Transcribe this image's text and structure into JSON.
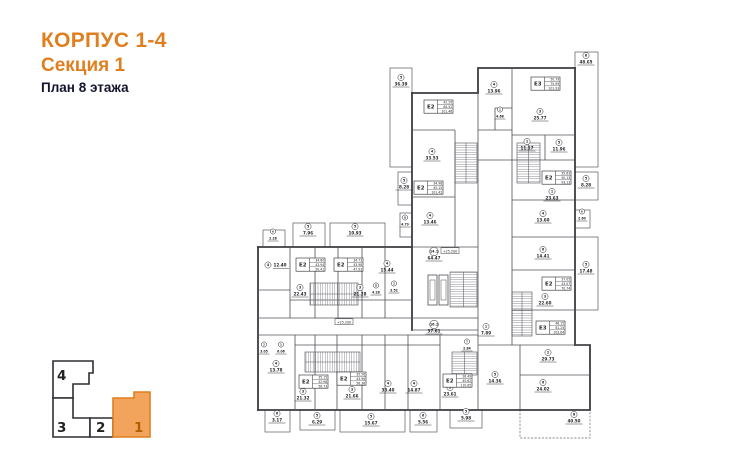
{
  "title": {
    "line1": "КОРПУС 1-4",
    "line2": "Секция 1",
    "line3": "План 8 этажа"
  },
  "colors": {
    "accent_orange": "#e07f1f",
    "keyplan_active_fill": "#f2a45c",
    "ink": "#26262b",
    "wall": "#3c3c41"
  },
  "keyplan": {
    "sections": [
      {
        "label": "4",
        "active": false
      },
      {
        "label": "3",
        "active": false
      },
      {
        "label": "2",
        "active": false
      },
      {
        "label": "1",
        "active": true
      }
    ]
  },
  "plan": {
    "floor_level_marks": [
      {
        "text": "+25.200",
        "x": 450,
        "y": 252
      },
      {
        "text": "+25.200",
        "x": 344,
        "y": 323
      }
    ],
    "apartments": [
      {
        "label": "E2",
        "values": [
          "42.20",
          "64.52",
          "101.46"
        ],
        "x": 424,
        "y": 100
      },
      {
        "label": "E3",
        "values": [
          "50.79",
          "75.99",
          "101.93"
        ],
        "x": 531,
        "y": 77
      },
      {
        "label": "E2",
        "values": [
          "34.98",
          "45.15",
          "101.42"
        ],
        "x": 414,
        "y": 181
      },
      {
        "label": "E2",
        "values": [
          "35.63",
          "50.13",
          "93.13"
        ],
        "x": 542,
        "y": 171
      },
      {
        "label": "E2",
        "values": [
          "37.05",
          "43.07",
          "70.74"
        ],
        "x": 542,
        "y": 277
      },
      {
        "label": "E3",
        "values": [
          "48.15",
          "61.25",
          "103.64"
        ],
        "x": 536,
        "y": 321
      },
      {
        "label": "E2",
        "values": [
          "26.49",
          "45.62",
          "110.65"
        ],
        "x": 443,
        "y": 374
      },
      {
        "label": "E2",
        "values": [
          "34.60",
          "43.94",
          "50.41"
        ],
        "x": 296,
        "y": 258
      },
      {
        "label": "E2",
        "values": [
          "34.73",
          "43.98",
          "47.93"
        ],
        "x": 334,
        "y": 258
      },
      {
        "label": "E2",
        "values": [
          "35.15",
          "52.98",
          "56.73"
        ],
        "x": 299,
        "y": 375
      },
      {
        "label": "E2",
        "values": [
          "35.56",
          "43.96",
          "56.36"
        ],
        "x": 337,
        "y": 372
      }
    ],
    "rooms": [
      {
        "n": "5",
        "area": "36.39",
        "x": 401,
        "y": 84
      },
      {
        "n": "8",
        "area": "48.65",
        "x": 586,
        "y": 62
      },
      {
        "n": "4",
        "area": "13.96",
        "x": 494,
        "y": 91
      },
      {
        "n": "3",
        "area": "25.77",
        "x": 540,
        "y": 118
      },
      {
        "n": "2",
        "area": "4.68",
        "x": 500,
        "y": 116,
        "small": true
      },
      {
        "n": "1",
        "area": "11.17",
        "x": 527,
        "y": 148
      },
      {
        "n": "5",
        "area": "11.96",
        "x": 559,
        "y": 149
      },
      {
        "n": "4",
        "area": "33.53",
        "x": 432,
        "y": 158
      },
      {
        "n": "5",
        "area": "8.28",
        "x": 404,
        "y": 187
      },
      {
        "n": "5",
        "area": "8.28",
        "x": 586,
        "y": 185
      },
      {
        "n": "1",
        "area": "23.63",
        "x": 552,
        "y": 198
      },
      {
        "n": "4",
        "area": "13.46",
        "x": 430,
        "y": 222
      },
      {
        "n": "8",
        "area": "4.79",
        "x": 405,
        "y": 224,
        "small": true
      },
      {
        "n": "4",
        "area": "13.60",
        "x": 543,
        "y": 220
      },
      {
        "n": "6",
        "area": "2.60",
        "x": 582,
        "y": 218,
        "small": true
      },
      {
        "n": "14.1",
        "area": "64.47",
        "x": 434,
        "y": 258
      },
      {
        "n": "6",
        "area": "14.41",
        "x": 543,
        "y": 256
      },
      {
        "n": "5",
        "area": "17.48",
        "x": 586,
        "y": 271
      },
      {
        "n": "3",
        "area": "22.60",
        "x": 545,
        "y": 303
      },
      {
        "n": "16.1",
        "area": "37.61",
        "x": 434,
        "y": 331
      },
      {
        "n": "1",
        "area": "7.89",
        "x": 486,
        "y": 333
      },
      {
        "n": "7",
        "area": "2.84",
        "x": 467,
        "y": 348,
        "small": true
      },
      {
        "n": "2",
        "area": "29.73",
        "x": 548,
        "y": 359
      },
      {
        "n": "5",
        "area": "14.36",
        "x": 495,
        "y": 381
      },
      {
        "n": "6",
        "area": "24.02",
        "x": 543,
        "y": 389
      },
      {
        "n": "8",
        "area": "40.50",
        "x": 574,
        "y": 421
      },
      {
        "n": "5",
        "area": "5.98",
        "x": 466,
        "y": 418
      },
      {
        "n": "3",
        "area": "23.61",
        "x": 450,
        "y": 394
      },
      {
        "n": "4",
        "area": "14.87",
        "x": 414,
        "y": 390
      },
      {
        "n": "4",
        "area": "33.40",
        "x": 388,
        "y": 390
      },
      {
        "n": "3",
        "area": "21.66",
        "x": 352,
        "y": 396
      },
      {
        "n": "3",
        "area": "21.32",
        "x": 303,
        "y": 398
      },
      {
        "n": "4",
        "area": "13.78",
        "x": 276,
        "y": 370
      },
      {
        "n": "2",
        "area": "3.05",
        "x": 264,
        "y": 351,
        "small": true
      },
      {
        "n": "1",
        "area": "6.06",
        "x": 281,
        "y": 351,
        "small": true
      },
      {
        "n": "6",
        "area": "3.17",
        "x": 277,
        "y": 420
      },
      {
        "n": "5",
        "area": "6.29",
        "x": 317,
        "y": 422
      },
      {
        "n": "5",
        "area": "15.67",
        "x": 371,
        "y": 423
      },
      {
        "n": "6",
        "area": "5.56",
        "x": 423,
        "y": 422
      },
      {
        "n": "6",
        "area": "2.28",
        "x": 273,
        "y": 238,
        "small": true
      },
      {
        "n": "5",
        "area": "7.96",
        "x": 308,
        "y": 233
      },
      {
        "n": "5",
        "area": "10.93",
        "x": 355,
        "y": 233
      },
      {
        "n": "4",
        "area": "12.40",
        "x": 268,
        "y": 266,
        "inline": true
      },
      {
        "n": "4",
        "area": "15.44",
        "x": 387,
        "y": 270
      },
      {
        "n": "3",
        "area": "22.43",
        "x": 300,
        "y": 294
      },
      {
        "n": "3",
        "area": "21.28",
        "x": 360,
        "y": 294
      },
      {
        "n": "8",
        "area": "4.28",
        "x": 376,
        "y": 292,
        "small": true
      },
      {
        "n": "2",
        "area": "3.52",
        "x": 394,
        "y": 290,
        "small": true
      }
    ]
  }
}
